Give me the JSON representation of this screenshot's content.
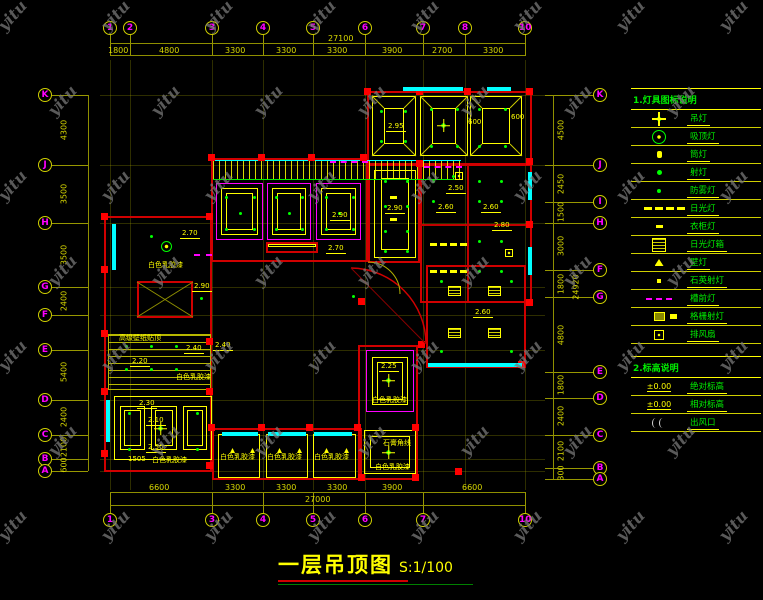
{
  "watermark": {
    "text": "yitu"
  },
  "title": {
    "text": "一层吊顶图",
    "scale": "S:1/100"
  },
  "grid": {
    "top": {
      "bubbles": [
        [
          "1",
          110
        ],
        [
          "2",
          130
        ],
        [
          "3",
          212
        ],
        [
          "4",
          263
        ],
        [
          "5",
          313
        ],
        [
          "6",
          365
        ],
        [
          "7",
          423
        ],
        [
          "8",
          465
        ],
        [
          "10",
          525
        ]
      ],
      "dims": [
        [
          "1800",
          120
        ],
        [
          "4800",
          171
        ],
        [
          "3300",
          237
        ],
        [
          "3300",
          288
        ],
        [
          "3300",
          339
        ],
        [
          "3900",
          394
        ],
        [
          "2700",
          444
        ],
        [
          "3300",
          495
        ]
      ],
      "total": "27100"
    },
    "bottom": {
      "bubbles": [
        [
          "1",
          110
        ],
        [
          "3",
          212
        ],
        [
          "4",
          263
        ],
        [
          "5",
          313
        ],
        [
          "6",
          365
        ],
        [
          "7",
          423
        ],
        [
          "10",
          525
        ]
      ],
      "dims": [
        [
          "6600",
          161
        ],
        [
          "3300",
          237
        ],
        [
          "3300",
          288
        ],
        [
          "3300",
          339
        ],
        [
          "3900",
          394
        ],
        [
          "6600",
          474
        ]
      ],
      "total": "27000"
    },
    "left": {
      "bubbles": [
        [
          "K",
          95
        ],
        [
          "J",
          165
        ],
        [
          "H",
          223
        ],
        [
          "G",
          287
        ],
        [
          "F",
          315
        ],
        [
          "E",
          350
        ],
        [
          "D",
          400
        ],
        [
          "C",
          435
        ],
        [
          "B",
          459
        ],
        [
          "A",
          471
        ]
      ],
      "dims": [
        [
          "4300",
          130
        ],
        [
          "3500",
          194
        ],
        [
          "3500",
          255
        ],
        [
          "2400",
          301
        ],
        [
          "5400",
          372
        ],
        [
          "2400",
          417
        ],
        [
          "2100",
          447
        ],
        [
          "600",
          465
        ]
      ]
    },
    "right": {
      "bubbles": [
        [
          "K",
          95
        ],
        [
          "J",
          165
        ],
        [
          "I",
          202
        ],
        [
          "H",
          223
        ],
        [
          "F",
          270
        ],
        [
          "G",
          297
        ],
        [
          "E",
          372
        ],
        [
          "D",
          398
        ],
        [
          "C",
          435
        ],
        [
          "B",
          468
        ],
        [
          "A",
          479
        ]
      ],
      "dims": [
        [
          "4500",
          130
        ],
        [
          "2450",
          184
        ],
        [
          "1500",
          212
        ],
        [
          "3000",
          246
        ],
        [
          "1800",
          284
        ],
        [
          "4800",
          335
        ],
        [
          "1800",
          385
        ],
        [
          "2400",
          416
        ],
        [
          "2100",
          451
        ],
        [
          "300",
          473
        ]
      ],
      "total": "24920"
    }
  },
  "legend": {
    "section1_title": "1.灯具图标说明",
    "items": [
      {
        "icon": "chandelier-icon",
        "label": "吊灯"
      },
      {
        "icon": "ceiling-lamp-icon",
        "label": "吸顶灯"
      },
      {
        "icon": "downlight-icon",
        "label": "筒灯"
      },
      {
        "icon": "spotlight-icon",
        "label": "射灯"
      },
      {
        "icon": "fog-lamp-icon",
        "label": "防雾灯"
      },
      {
        "icon": "fluorescent-lamp-icon",
        "label": "日光灯"
      },
      {
        "icon": "wardrobe-lamp-icon",
        "label": "衣柜灯"
      },
      {
        "icon": "fluorescent-lightbox-icon",
        "label": "日光灯箱"
      },
      {
        "icon": "wall-lamp-icon",
        "label": "壁灯"
      },
      {
        "icon": "quartz-spotlight-icon",
        "label": "石英射灯"
      },
      {
        "icon": "cove-light-icon",
        "label": "槽前灯"
      },
      {
        "icon": "grille-spotlight-icon",
        "label": "格栅射灯"
      },
      {
        "icon": "exhaust-fan-icon",
        "label": "排风扇"
      }
    ],
    "section2_title": "2.标高说明",
    "items2": [
      {
        "icon": "abs-elevation-icon",
        "symbol": "±0.00",
        "label": "绝对标高"
      },
      {
        "icon": "rel-elevation-icon",
        "symbol": "±0.00",
        "label": "相对标高"
      },
      {
        "icon": "air-outlet-icon",
        "symbol": "",
        "label": "出风口"
      }
    ]
  },
  "plan_labels": [
    {
      "text": "2.70",
      "x": 180,
      "y": 229,
      "u": true
    },
    {
      "text": "白色乳胶漆",
      "x": 148,
      "y": 260
    },
    {
      "text": "2.90",
      "x": 192,
      "y": 282,
      "u": true
    },
    {
      "text": "2.90",
      "x": 330,
      "y": 211,
      "u": true
    },
    {
      "text": "2.70",
      "x": 326,
      "y": 244,
      "u": true
    },
    {
      "text": "2.95",
      "x": 386,
      "y": 122,
      "u": true
    },
    {
      "text": "600",
      "x": 468,
      "y": 118
    },
    {
      "text": "600",
      "x": 511,
      "y": 113
    },
    {
      "text": "2.90",
      "x": 385,
      "y": 204,
      "u": true
    },
    {
      "text": "2.50",
      "x": 446,
      "y": 184,
      "u": true
    },
    {
      "text": "2.60",
      "x": 436,
      "y": 203,
      "u": true
    },
    {
      "text": "2.60",
      "x": 481,
      "y": 203,
      "u": true
    },
    {
      "text": "2.80",
      "x": 492,
      "y": 221,
      "u": true
    },
    {
      "text": "2.60",
      "x": 473,
      "y": 308,
      "u": true
    },
    {
      "text": "2.25",
      "x": 379,
      "y": 362,
      "u": true
    },
    {
      "text": "白色乳胶漆",
      "x": 372,
      "y": 395
    },
    {
      "text": "石膏角线",
      "x": 383,
      "y": 438
    },
    {
      "text": "白色乳胶漆",
      "x": 375,
      "y": 462
    },
    {
      "text": "白色乳胶漆",
      "x": 220,
      "y": 452
    },
    {
      "text": "白色乳胶漆",
      "x": 267,
      "y": 452
    },
    {
      "text": "白色乳胶漆",
      "x": 314,
      "y": 452
    },
    {
      "text": "高级壁纸贴顶",
      "x": 119,
      "y": 333
    },
    {
      "text": "2.20",
      "x": 130,
      "y": 357,
      "u": true
    },
    {
      "text": "2.40",
      "x": 184,
      "y": 344,
      "u": true
    },
    {
      "text": "白色乳胶漆",
      "x": 176,
      "y": 372
    },
    {
      "text": "2.30",
      "x": 137,
      "y": 399,
      "u": true
    },
    {
      "text": "2.10",
      "x": 146,
      "y": 416,
      "u": true
    },
    {
      "text": "2.50",
      "x": 146,
      "y": 443,
      "u": true
    },
    {
      "text": "1505",
      "x": 128,
      "y": 455
    },
    {
      "text": "白色乳胶漆",
      "x": 152,
      "y": 455
    },
    {
      "text": "2.40",
      "x": 213,
      "y": 341,
      "u": true
    }
  ],
  "colors": {
    "background": "#000000",
    "walls": "#d00000",
    "dimensions": "#d8d800",
    "bubble_text": "#ff00ff",
    "legend_text": "#00ee00",
    "accent_yellow": "#ffff00",
    "magenta": "#ff00ff",
    "lights_green": "#00ff00",
    "windows_cyan": "#00ffff",
    "title": "#ffff00",
    "watermark": "#787878"
  }
}
